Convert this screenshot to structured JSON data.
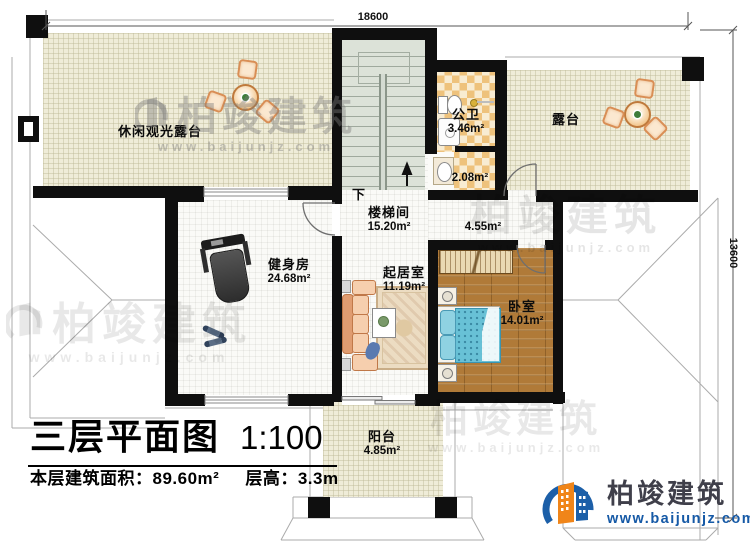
{
  "page": {
    "title": "三层平面图",
    "scale": "1:100",
    "area_label": "本层建筑面积：",
    "area_value": "89.60m²",
    "floor_height_label": "层高：",
    "floor_height_value": "3.3m"
  },
  "dimensions": {
    "top": "18600",
    "right": "13600"
  },
  "rooms": {
    "leisure_terrace": {
      "name": "休闲观光露台"
    },
    "bath": {
      "name": "公卫",
      "area": "3.46m²"
    },
    "bath_annex": {
      "area": "2.08m²"
    },
    "terrace": {
      "name": "露台"
    },
    "stairwell": {
      "name": "楼梯间",
      "area": "15.20m²"
    },
    "corridor": {
      "area": "4.55m²"
    },
    "gym": {
      "name": "健身房",
      "area": "24.68m²"
    },
    "living": {
      "name": "起居室",
      "area": "11.19m²"
    },
    "bedroom": {
      "name": "卧室",
      "area": "14.01m²"
    },
    "balcony": {
      "name": "阳台",
      "area": "4.85m²"
    }
  },
  "stairs": {
    "down_label": "下"
  },
  "brand": {
    "name": "柏竣建筑",
    "url": "www.baijunjz.com"
  },
  "watermark": {
    "name": "柏竣建筑",
    "url": "www.baijunjz.com"
  },
  "colors": {
    "wall": "#0f0f0f",
    "terrace_floor": "#efecd8",
    "tile_orange": "#eec27c",
    "wood": "#b07a38",
    "bed_teal": "#68c1d6",
    "brand_blue": "#1559a6",
    "brand_orange": "#f08519"
  }
}
